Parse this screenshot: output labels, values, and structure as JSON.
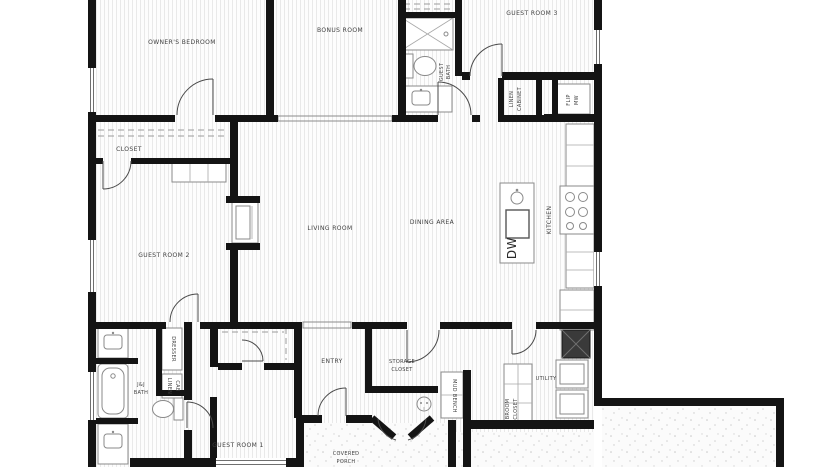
{
  "labels": {
    "owners_bedroom": "OWNER'S BEDROOM",
    "bonus_room": "BONUS ROOM",
    "guest_room_3": "GUEST ROOM 3",
    "guest_bath": {
      "l1": "GUEST",
      "l2": "BATH"
    },
    "linen_cabinet": {
      "l1": "LINEN",
      "l2": "CABINET"
    },
    "flip_mw": {
      "l1": "FLIP",
      "l2": "MW"
    },
    "kitchen": "KITCHEN",
    "dishwasher": "DW",
    "closet": "CLOSET",
    "guest_room_2": "GUEST ROOM 2",
    "living_room": "LIVING ROOM",
    "dining_area": "DINING AREA",
    "jj_bath": {
      "l1": "J&J",
      "l2": "BATH"
    },
    "dresser": "DRESSER",
    "linen_cab": {
      "l1": "LINEN",
      "l2": "CAB"
    },
    "entry": "ENTRY",
    "storage_closet": {
      "l1": "STORAGE",
      "l2": "CLOSET"
    },
    "mud_bench": "MUD BENCH",
    "utility": "UTILITY",
    "broom_closet": {
      "l1": "BROOM",
      "l2": "CLOSET"
    },
    "guest_room_1": "GUEST ROOM 1",
    "covered_porch": {
      "l1": "COVERED",
      "l2": "PORCH"
    }
  },
  "colors": {
    "wall": "#141414",
    "fixture_line": "#8a8a8a",
    "floor_stripe": "#e9e9e9",
    "stipple_dot": "#c8c8c8",
    "label_text": "#3f3f3f",
    "background": "#ffffff"
  }
}
